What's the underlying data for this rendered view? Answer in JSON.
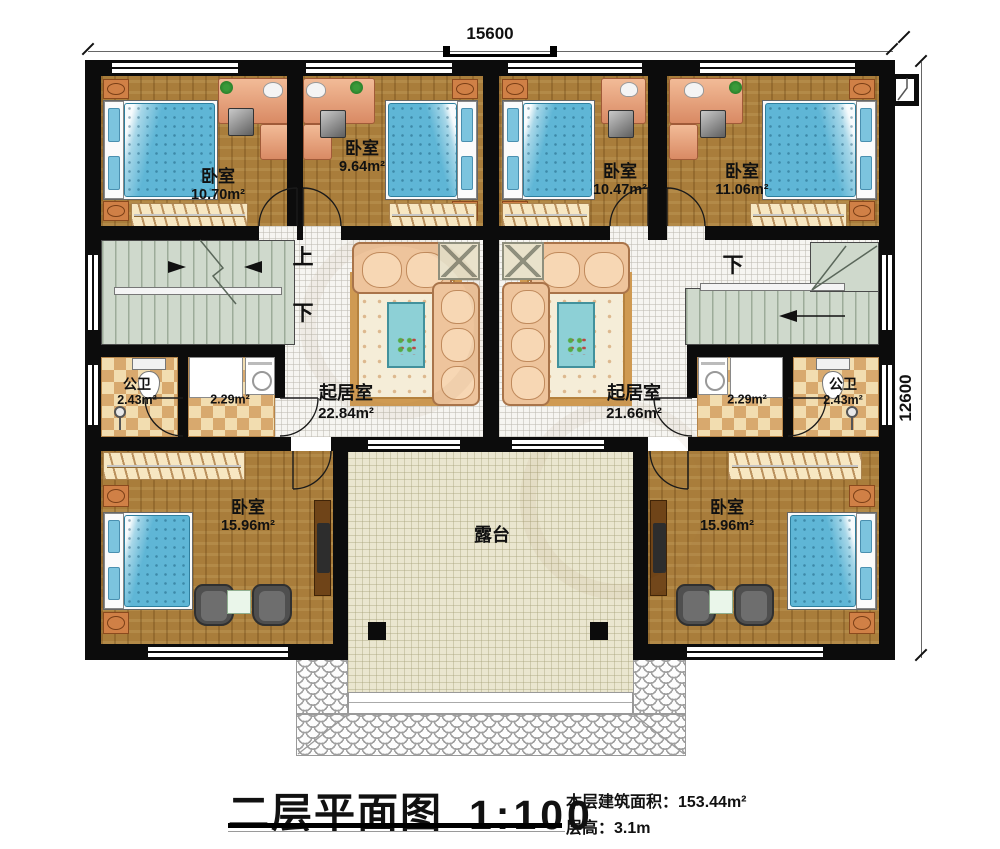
{
  "plan": {
    "dim_top": "15600",
    "dim_right": "12600",
    "stair_up": "上",
    "stair_down": "下",
    "rooms": {
      "bedroom_tl": {
        "name": "卧室",
        "area": "10.70m²"
      },
      "bedroom_tml": {
        "name": "卧室",
        "area": "9.64m²"
      },
      "bedroom_tmr": {
        "name": "卧室",
        "area": "10.47m²"
      },
      "bedroom_tr": {
        "name": "卧室",
        "area": "11.06m²"
      },
      "bath_left": {
        "name": "公卫",
        "area": "2.43m²"
      },
      "laundry_left": {
        "area": "2.29m²"
      },
      "living_left": {
        "name": "起居室",
        "area": "22.84m²"
      },
      "living_right": {
        "name": "起居室",
        "area": "21.66m²"
      },
      "laundry_right": {
        "area": "2.29m²"
      },
      "bath_right": {
        "name": "公卫",
        "area": "2.43m²"
      },
      "bedroom_bl": {
        "name": "卧室",
        "area": "15.96m²"
      },
      "bedroom_br": {
        "name": "卧室",
        "area": "15.96m²"
      },
      "terrace": {
        "name": "露台"
      }
    }
  },
  "title_block": {
    "title": "二层平面图",
    "scale": "1:100",
    "area_note": "本层建筑面积：153.44m²",
    "floor_height_note": "层高：3.1m"
  },
  "colors": {
    "wall": "#0c0c0c",
    "wood_floor": "#a97d3b",
    "tile_floor": "#f6f5f1",
    "stair": "#cfd9cc",
    "bath_checker_light": "#f2ddb0",
    "bath_checker_dark": "#d8a96e",
    "terrace_floor": "#eae6cf",
    "bed": "#5fb6d6",
    "sofa": "#eec49c"
  }
}
